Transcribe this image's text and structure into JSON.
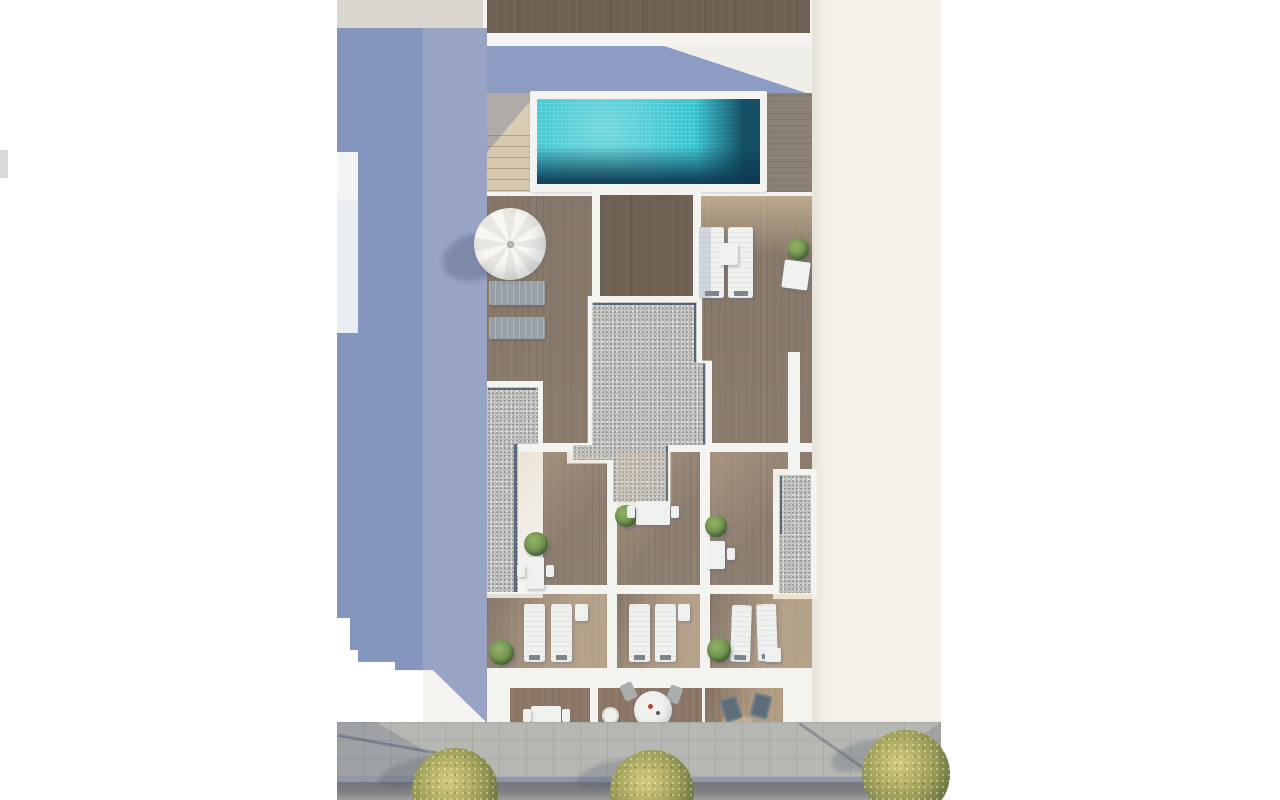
{
  "scene": {
    "type": "aerial-architectural-render",
    "subject": "Top-down 3D render of a residential building: rooftop pool terrace with parasol, gravel roof sections, three apartment terraces with sun loungers, three street-level balconies, sidewalk with trees and street",
    "inventory": {
      "swimming_pool": 1,
      "parasol": 1,
      "staircase": 1,
      "trees": 3,
      "apartment_terraces": 3,
      "street_balconies": 3,
      "sun_loungers": 10,
      "dining_sets": 6,
      "potted_plants": 8,
      "gravel_roof_sections": 3
    }
  },
  "colors": {
    "page_bg": "#ffffff",
    "building_white": "#f4f3f0",
    "wall_white": "#f3f3f0",
    "cream_building": "#f2f0e9",
    "neighbor_strip": "#d8d6cf",
    "shadow_ground": "#8495be",
    "shadow_walkway": "#99a4c5",
    "shadow_terrace": "#8d9cc2",
    "deck_dark": "#6e6153",
    "deck_main": "#8d7e6f",
    "balcony_wood": "#8d7867",
    "stairs_wood": "#dbccb4",
    "pool_water": "#3ac2cc",
    "pool_deep": "#12455f",
    "gravel_base": "#c7c7c5",
    "roof_edge": "#44546a",
    "lounger_gray": "#98a0a6",
    "furniture_white": "#eff1ef",
    "chair_dark": "#5f6d78",
    "chair_gray": "#a9adac",
    "plant_green": "#6f9350",
    "tree_olive": "#a8a75f",
    "ramp_tan": "#d9c7a6",
    "sidewalk": "#b6b7b3",
    "curb": "#8e98ab",
    "street_dark": "#74767a",
    "street_light": "#9d9f9c",
    "accent_red": "#b8413a"
  }
}
